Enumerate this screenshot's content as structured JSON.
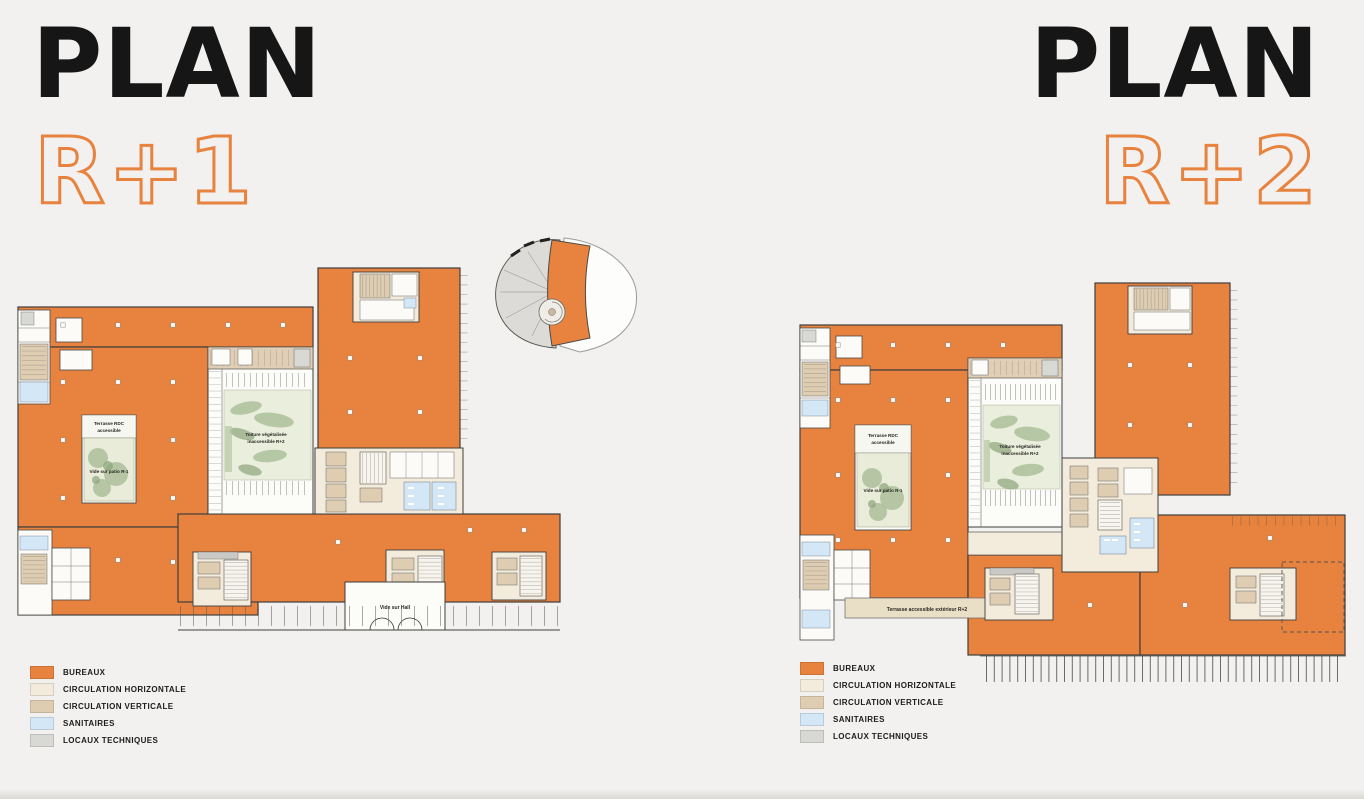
{
  "page": {
    "background": "#F2F1EF"
  },
  "colors": {
    "accent_orange": "#E8823F",
    "plan_wall": "#3E3E3C",
    "circulation_horizontale": "#F3ECDC",
    "circulation_verticale": "#DFCDB2",
    "sanitaires": "#D3E7F6",
    "locaux_techniques": "#D8D8D4"
  },
  "panels": [
    {
      "id": "r+1",
      "title": "PLAN",
      "level": "R+1",
      "plan_labels": {
        "terrace_line1": "Terrasse RDC",
        "terrace_line2": "accessible",
        "patio": "Vide sur patio R-1",
        "roof_line1": "Toiture végétalisée",
        "roof_line2": "inaccessible R+2",
        "hall": "Vide sur Hall"
      }
    },
    {
      "id": "r+2",
      "title": "PLAN",
      "level": "R+2",
      "plan_labels": {
        "terrace_line1": "Terrasse RDC",
        "terrace_line2": "accessible",
        "patio": "Vide sur patio R-1",
        "roof_line1": "Toiture végétalisée",
        "roof_line2": "inaccessible R+2",
        "terrace_ext": "Terrasse accessible extérieur R+2"
      }
    }
  ],
  "legend": {
    "items": [
      {
        "label": "BUREAUX",
        "color": "#E8823F"
      },
      {
        "label": "CIRCULATION HORIZONTALE",
        "color": "#F3ECDC"
      },
      {
        "label": "CIRCULATION VERTICALE",
        "color": "#DFCDB2"
      },
      {
        "label": "SANITAIRES",
        "color": "#D3E7F6"
      },
      {
        "label": "LOCAUX TECHNIQUES",
        "color": "#D8D8D4"
      }
    ]
  }
}
